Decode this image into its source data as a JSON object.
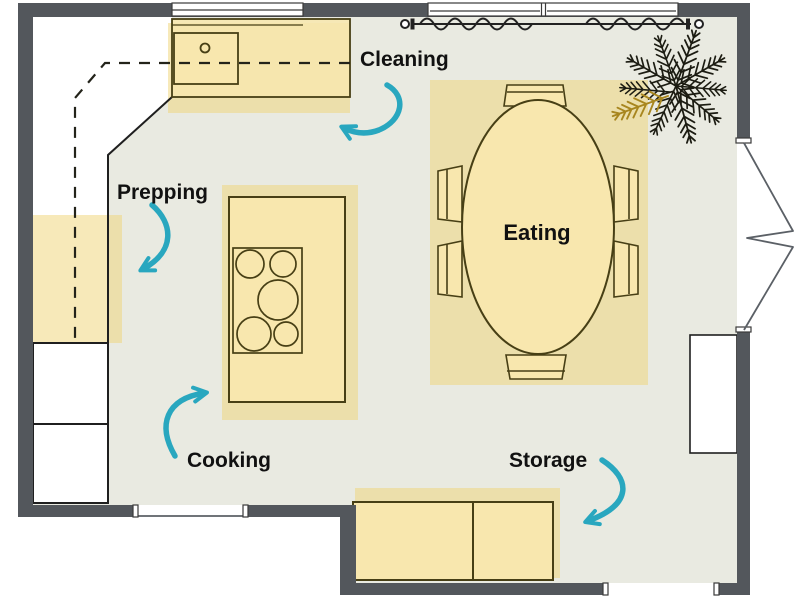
{
  "title": "Kitchen zone floor plan",
  "zones": {
    "cleaning": {
      "label": "Cleaning"
    },
    "prepping": {
      "label": "Prepping"
    },
    "eating": {
      "label": "Eating"
    },
    "cooking": {
      "label": "Cooking"
    },
    "storage": {
      "label": "Storage"
    }
  },
  "colors": {
    "wall": "#53575c",
    "floor": "#e9eae1",
    "zone": "#f0d478",
    "furn": "#f8e7ae",
    "outline": "#473f15",
    "arrow": "#29a7bf",
    "ink": "#111111",
    "plant": "#1c1c12",
    "plant_accent": "#a8861f"
  }
}
